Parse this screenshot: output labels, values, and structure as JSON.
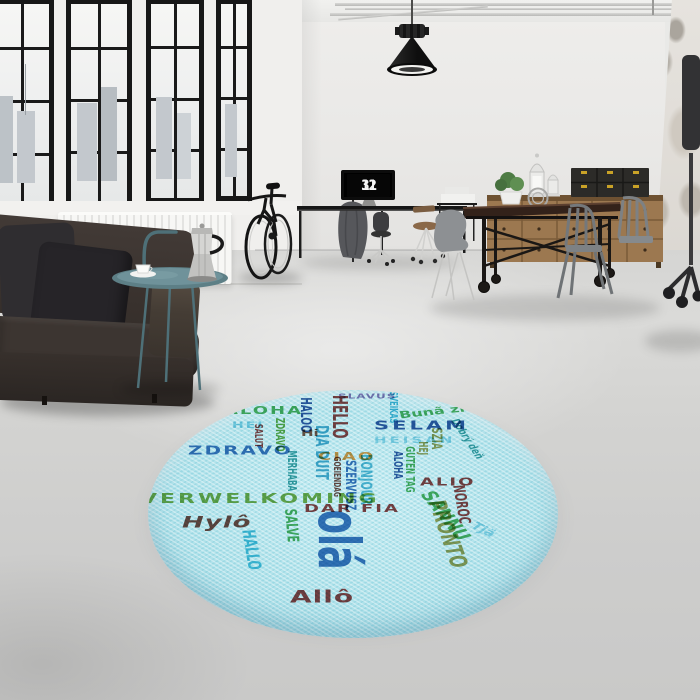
{
  "scene_title": "Loft interior with round multilingual hello rug",
  "clock": {
    "hours": "11",
    "minutes": "32"
  },
  "palette": {
    "wall": "#e9e8e6",
    "floor": "#d2d2d0",
    "window_frame": "#171717",
    "sofa": "#3a332f",
    "wood": "#9c7850",
    "rug_base": "#b0e2ea",
    "box_clasp": "#c9a227",
    "table_teal": "#5d7f86"
  },
  "rug": {
    "base_color": "#b0e2ea",
    "words": [
      {
        "text": "ALOHA",
        "x": 76,
        "y": 26,
        "size": 18,
        "color": "#3fae54",
        "ls": 2
      },
      {
        "text": "HEI",
        "x": 84,
        "y": 52,
        "size": 14,
        "color": "#7fd4e8",
        "ls": 2
      },
      {
        "text": "SALUT",
        "x": 116,
        "y": 56,
        "size": 11,
        "color": "#8a3434",
        "rot": 90
      },
      {
        "text": "ZDRAVO",
        "x": 138,
        "y": 46,
        "size": 12,
        "color": "#58a83c",
        "rot": 90
      },
      {
        "text": "MERHABA",
        "x": 150,
        "y": 100,
        "size": 12,
        "color": "#2a9d9f",
        "rot": 90
      },
      {
        "text": "ZDRAVO",
        "x": 40,
        "y": 90,
        "size": 20,
        "color": "#2b6cb8",
        "ls": 2
      },
      {
        "text": "HALOO",
        "x": 165,
        "y": 12,
        "size": 15,
        "color": "#1d4f9c",
        "rot": 90
      },
      {
        "text": "DIA DUIT",
        "x": 182,
        "y": 58,
        "size": 18,
        "color": "#3aa8cc",
        "rot": 90
      },
      {
        "text": "HELLO",
        "x": 202,
        "y": 8,
        "size": 20,
        "color": "#8a3434",
        "rot": 90
      },
      {
        "text": "Hi",
        "x": 153,
        "y": 64,
        "size": 15,
        "color": "#7a4a38"
      },
      {
        "text": "CIAO",
        "x": 170,
        "y": 102,
        "size": 18,
        "color": "#e8923a",
        "ls": 2
      },
      {
        "text": "SLAVUS",
        "x": 190,
        "y": 4,
        "size": 12,
        "color": "#8070b0",
        "ls": 1
      },
      {
        "text": "GOEIENDAG",
        "x": 193,
        "y": 110,
        "size": 10,
        "color": "#6b3a32",
        "rot": 90
      },
      {
        "text": "SZERVUSZ",
        "x": 209,
        "y": 116,
        "size": 14,
        "color": "#2b6cb8",
        "rot": 90
      },
      {
        "text": "BONJOUR",
        "x": 226,
        "y": 106,
        "size": 16,
        "color": "#49b8d4",
        "rot": 90
      },
      {
        "text": "SELAM",
        "x": 226,
        "y": 48,
        "size": 21,
        "color": "#1d4f9c",
        "ls": 3
      },
      {
        "text": "HEISAN",
        "x": 226,
        "y": 76,
        "size": 15,
        "color": "#8fd8ea",
        "ls": 3
      },
      {
        "text": "Bunã ziu",
        "x": 250,
        "y": 34,
        "size": 16,
        "color": "#3fae54",
        "rot": -10
      },
      {
        "text": "SVEIKAS",
        "x": 251,
        "y": 2,
        "size": 11,
        "color": "#35b8d8",
        "rot": 90
      },
      {
        "text": "ALOHA",
        "x": 256,
        "y": 101,
        "size": 12,
        "color": "#1d4f9c",
        "rot": 90
      },
      {
        "text": "GUTEN TAG",
        "x": 268,
        "y": 93,
        "size": 12,
        "color": "#3fae54",
        "rot": 90
      },
      {
        "text": "HEJ",
        "x": 281,
        "y": 85,
        "size": 12,
        "color": "#9a9a4a",
        "rot": 90
      },
      {
        "text": "SZIA",
        "x": 295,
        "y": 62,
        "size": 14,
        "color": "#9a9a4a",
        "rot": 90
      },
      {
        "text": "Dobrý deň",
        "x": 312,
        "y": 46,
        "size": 12,
        "color": "#2a9d9f",
        "rot": 68
      },
      {
        "text": "ALIO",
        "x": 272,
        "y": 144,
        "size": 18,
        "color": "#8a3434",
        "ls": 2
      },
      {
        "text": "NOROC",
        "x": 318,
        "y": 156,
        "size": 16,
        "color": "#8a3434",
        "rot": 84
      },
      {
        "text": "SANNU",
        "x": 287,
        "y": 164,
        "size": 22,
        "color": "#3fae54",
        "rot": 64
      },
      {
        "text": "PRONTO",
        "x": 300,
        "y": 180,
        "size": 24,
        "color": "#9a9a4a",
        "rot": 78
      },
      {
        "text": "Tjä",
        "x": 330,
        "y": 216,
        "size": 16,
        "color": "#8fd8ea",
        "rot": 40
      },
      {
        "text": "VERWELKOMING",
        "x": -8,
        "y": 170,
        "size": 22,
        "color": "#6aa63e",
        "ls": 3
      },
      {
        "text": "Hylô",
        "x": 34,
        "y": 206,
        "size": 26,
        "color": "#6b3a32",
        "italic": true,
        "ls": 1
      },
      {
        "text": "HALLO",
        "x": 108,
        "y": 230,
        "size": 18,
        "color": "#3cc0dc",
        "rot": 84
      },
      {
        "text": "SALVE",
        "x": 150,
        "y": 196,
        "size": 16,
        "color": "#3fae54",
        "rot": 87
      },
      {
        "text": "DAR FIA",
        "x": 156,
        "y": 188,
        "size": 18,
        "color": "#8a3434",
        "ls": 2
      },
      {
        "text": "olá",
        "x": 220,
        "y": 198,
        "size": 58,
        "color": "#2b6cb8",
        "rot": 90
      },
      {
        "text": "Allô",
        "x": 142,
        "y": 328,
        "size": 28,
        "color": "#8a3434",
        "ls": 1
      }
    ]
  }
}
